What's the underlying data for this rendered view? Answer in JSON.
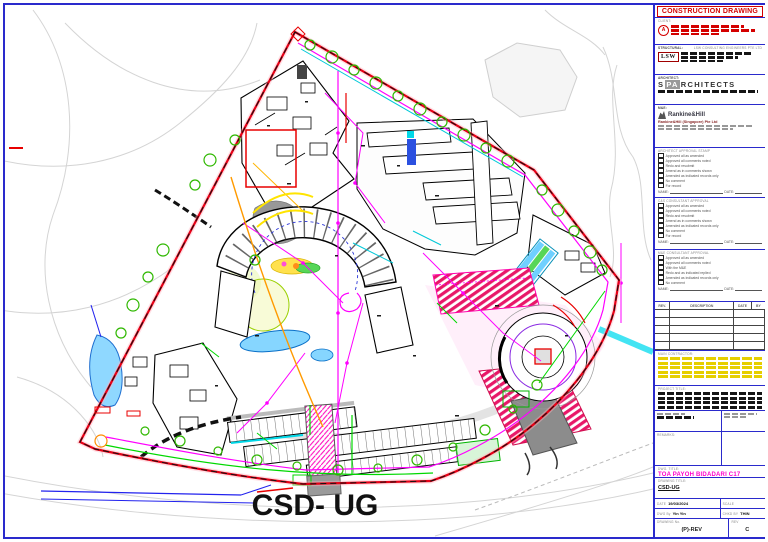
{
  "colors": {
    "frame_blue": "#2a2acc",
    "boundary_red": "#e80016",
    "accent_magenta": "#ff00ff",
    "title_magenta": "#ff00cc",
    "construction_red": "#d40000"
  },
  "drawing": {
    "big_label": "CSD- UG"
  },
  "titleblock": {
    "header": "CONSTRUCTION DRAWING",
    "client": {
      "label": "CLIENT:"
    },
    "structural": {
      "label": "STRUCTURAL:",
      "firm": "LSW CONSULTING ENGINEERS PTE LTD",
      "logo": "LSW"
    },
    "architect": {
      "label": "ARCHITECT:",
      "logo_prefix": "S",
      "logo_mid": "PA",
      "logo_suffix": "RCHITECTS"
    },
    "me": {
      "label": "M&E:",
      "logo": "Rankine&Hill",
      "firm": "Rankine&Hill (Singapore) Pte Ltd"
    },
    "sig": {
      "name_label": "NAME:",
      "date_label": "DATE:"
    },
    "approvals": [
      {
        "header": "ARCHITECT APPROVAL STAMP",
        "items": [
          "Approved all as amended",
          "Approved all comments noted",
          "Redo and resubmit",
          "Amend as in comments shown",
          "Amended as indicated records only",
          "No comment",
          "For record"
        ]
      },
      {
        "header": "C&S CONSULTANT APPROVAL",
        "items": [
          "Approved all as amended",
          "Approved all comments noted",
          "Redo and resubmit",
          "Amend as in comments shown",
          "Amended as indicated records only",
          "No comment",
          "For record"
        ]
      },
      {
        "header": "M&E CONSULTANT APPROVAL",
        "items": [
          "Approved all as amended",
          "Approved all comments noted",
          "With the M&E",
          "Redo and as indicated replied",
          "Amended as indicated records only",
          "No comment"
        ]
      }
    ],
    "revision_table": {
      "headers": [
        "REV.",
        "DESCRIPTION",
        "DATE",
        "BY"
      ],
      "empty_rows": 5
    },
    "contractor_label": "MAIN CONTRACTOR:",
    "contractor_lines": 5,
    "project_label": "PROJECT TITLE:",
    "project_lines": 4,
    "remarks_label": "REMARKS:",
    "dwg_title_label": "DWG. TITLE:",
    "dwg_title": "TOA PAYOH BIDADARI C17",
    "drawing_title_label": "DRAWING TITLE:",
    "drawing_title": "CSD-UG",
    "footer": {
      "date_label": "DATE",
      "date": "19/03/2024",
      "scale_label": "SCALE",
      "drawn_label": "DWG By",
      "drawn": "Yin Yin",
      "checked_label": "CHKD BY",
      "checked": "THIN",
      "dwgno_label": "DRAWING No.",
      "dwgno": "(P)-REV",
      "rev_label": "REV",
      "rev": "C"
    }
  }
}
